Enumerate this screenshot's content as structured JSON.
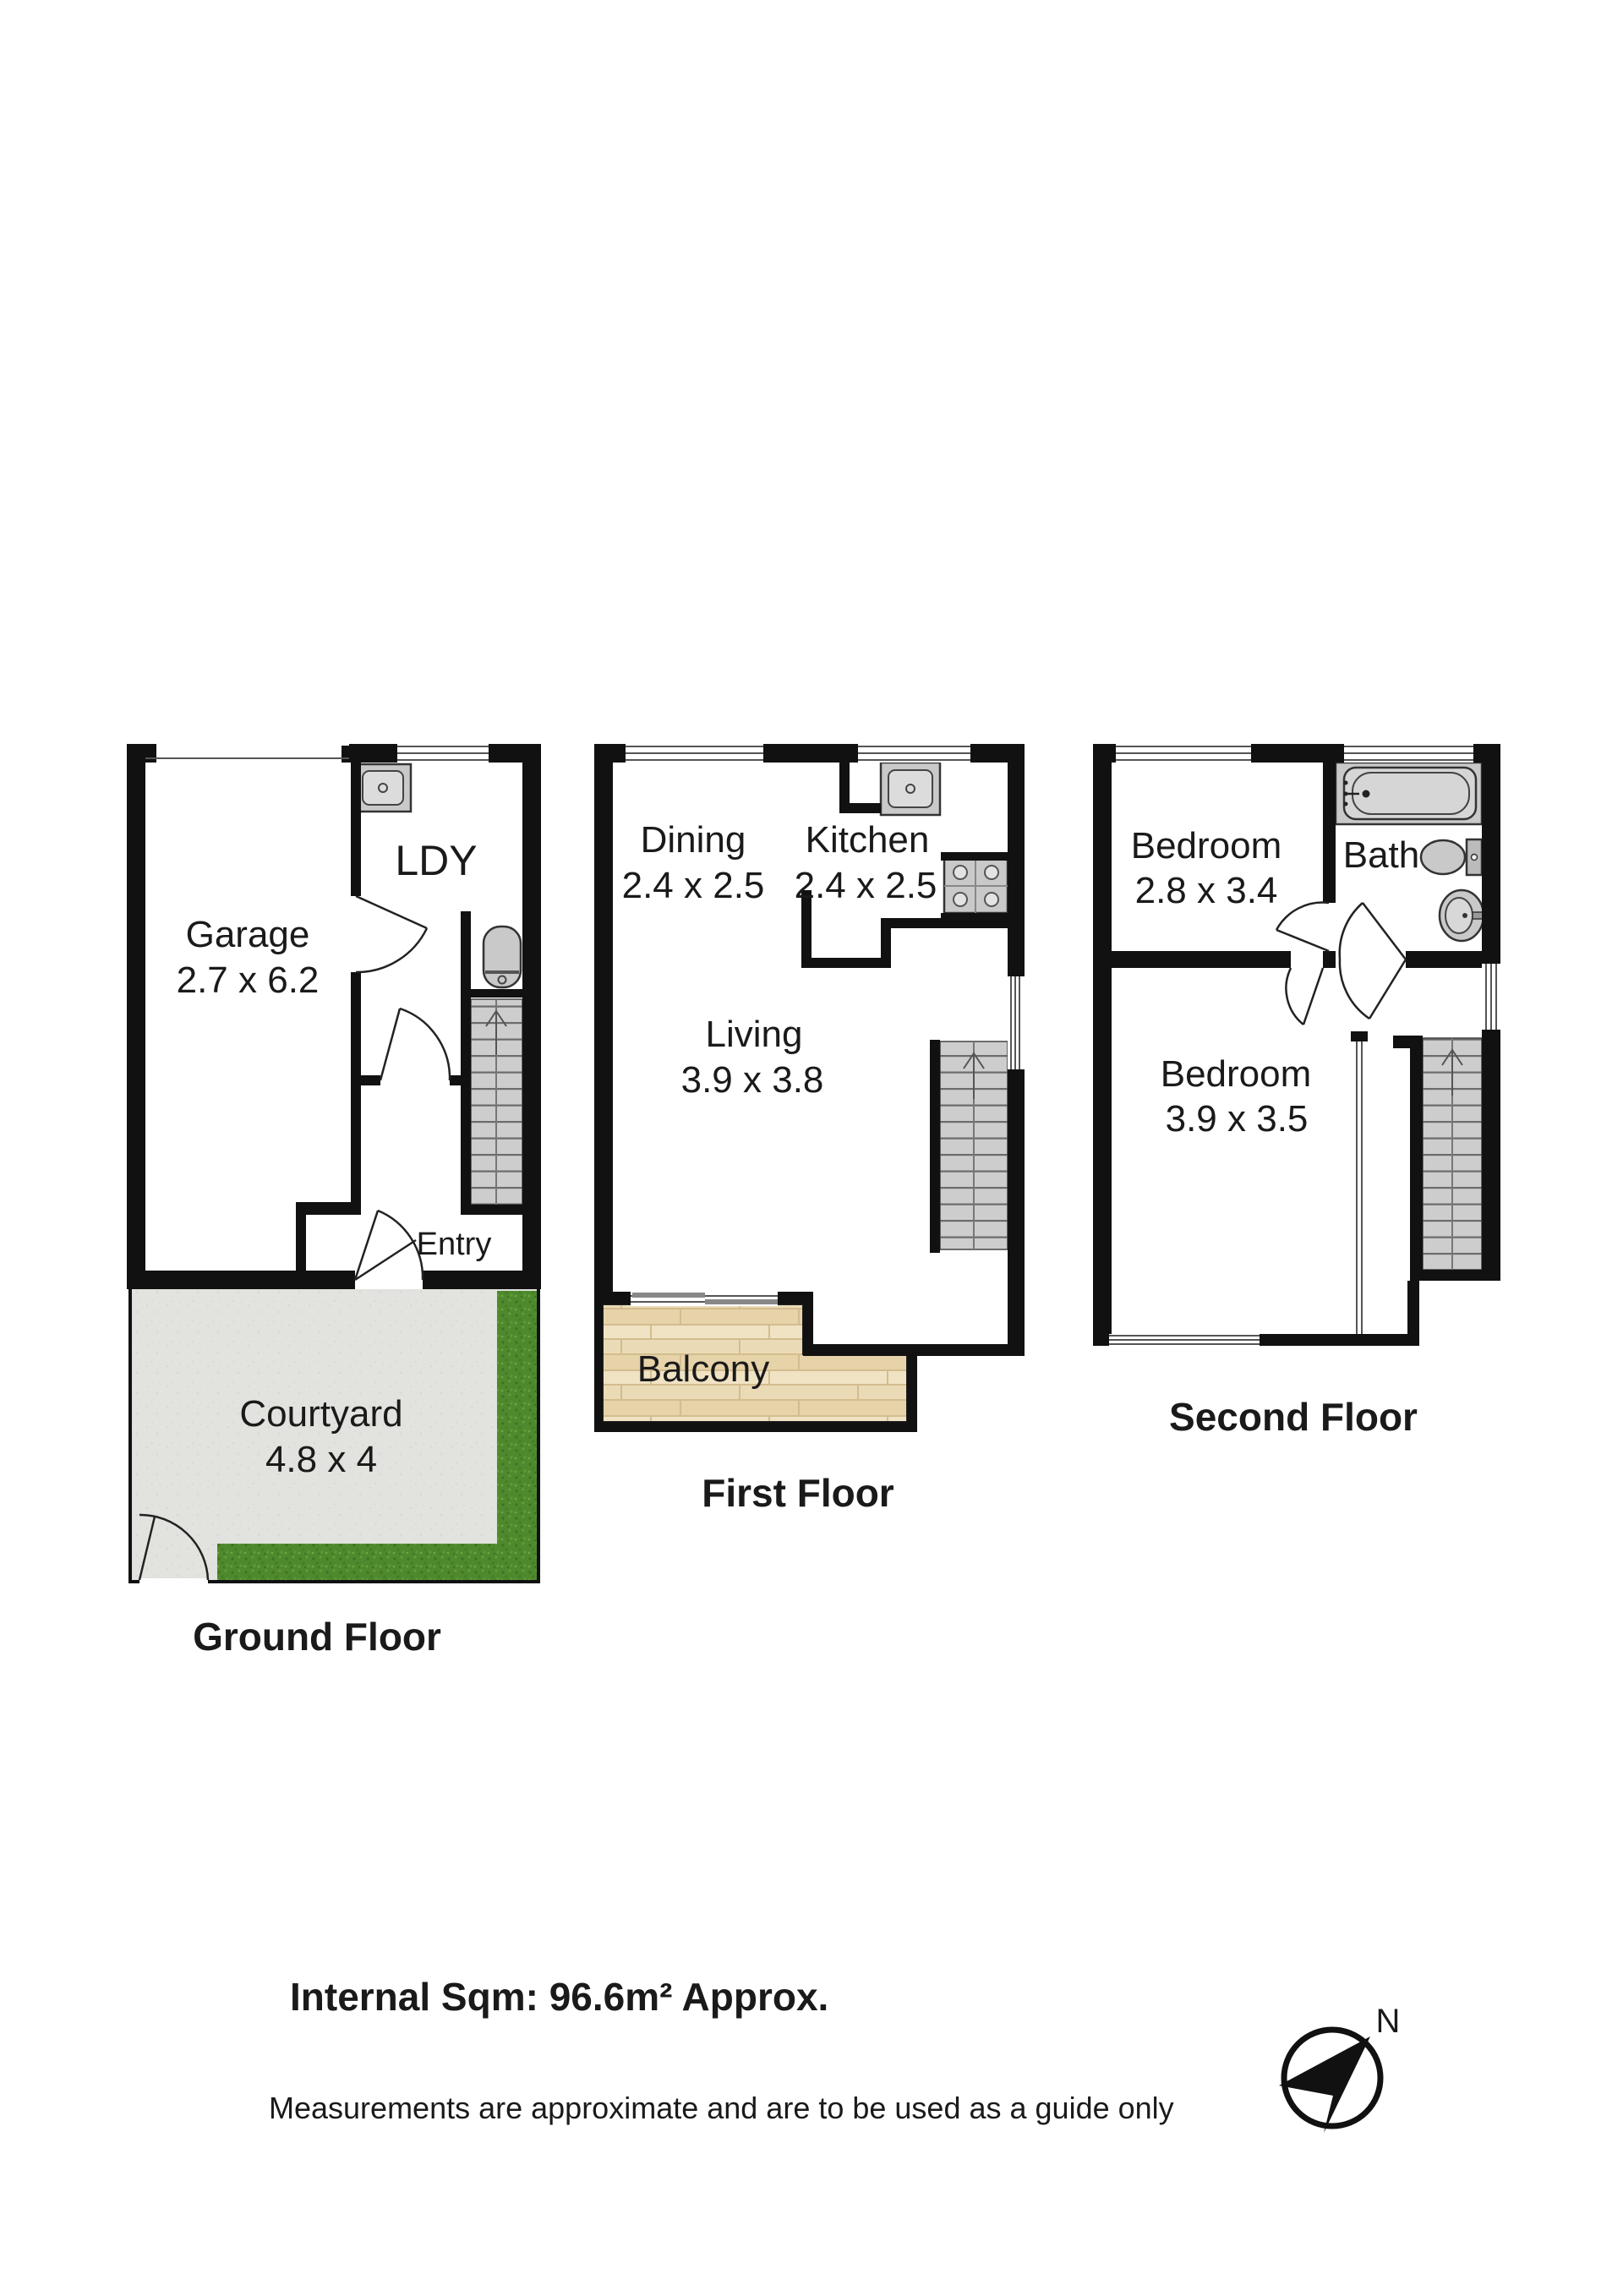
{
  "floors": [
    {
      "name": "Ground Floor",
      "rooms": [
        {
          "label": "Garage",
          "dims": "2.7 x 6.2"
        },
        {
          "label": "LDY",
          "dims": ""
        },
        {
          "label": "Entry",
          "dims": ""
        },
        {
          "label": "Courtyard",
          "dims": "4.8 x 4"
        }
      ]
    },
    {
      "name": "First Floor",
      "rooms": [
        {
          "label": "Dining",
          "dims": "2.4 x 2.5"
        },
        {
          "label": "Kitchen",
          "dims": "2.4 x 2.5"
        },
        {
          "label": "Living",
          "dims": "3.9 x 3.8"
        },
        {
          "label": "Balcony",
          "dims": ""
        }
      ]
    },
    {
      "name": "Second Floor",
      "rooms": [
        {
          "label": "Bedroom",
          "dims": "2.8 x 3.4"
        },
        {
          "label": "Bath",
          "dims": ""
        },
        {
          "label": "Bedroom",
          "dims": "3.9 x 3.5"
        }
      ]
    }
  ],
  "footer": {
    "internal_area": "Internal Sqm: 96.6m² Approx.",
    "disclaimer": "Measurements are approximate and are to be used as a guide only"
  },
  "compass": {
    "label": "N"
  },
  "icons": {
    "compass": "navigation-arrow",
    "stair_direction": "chevron-up-arrow",
    "laundry_tub": "sink",
    "kitchen_sink": "sink",
    "cooktop": "four-burner-stove",
    "bathtub": "bathtub",
    "toilet": "toilet",
    "basin": "pedestal-basin",
    "water_heater": "cylinder"
  },
  "colors": {
    "wall": "#111111",
    "text": "#1a1a1a",
    "grass": "#4e8a2d",
    "wood": "#eadbb6",
    "concrete": "#e2e2df",
    "fixture_gray": "#c9c9c9",
    "stair_gray": "#cdcdcd"
  }
}
